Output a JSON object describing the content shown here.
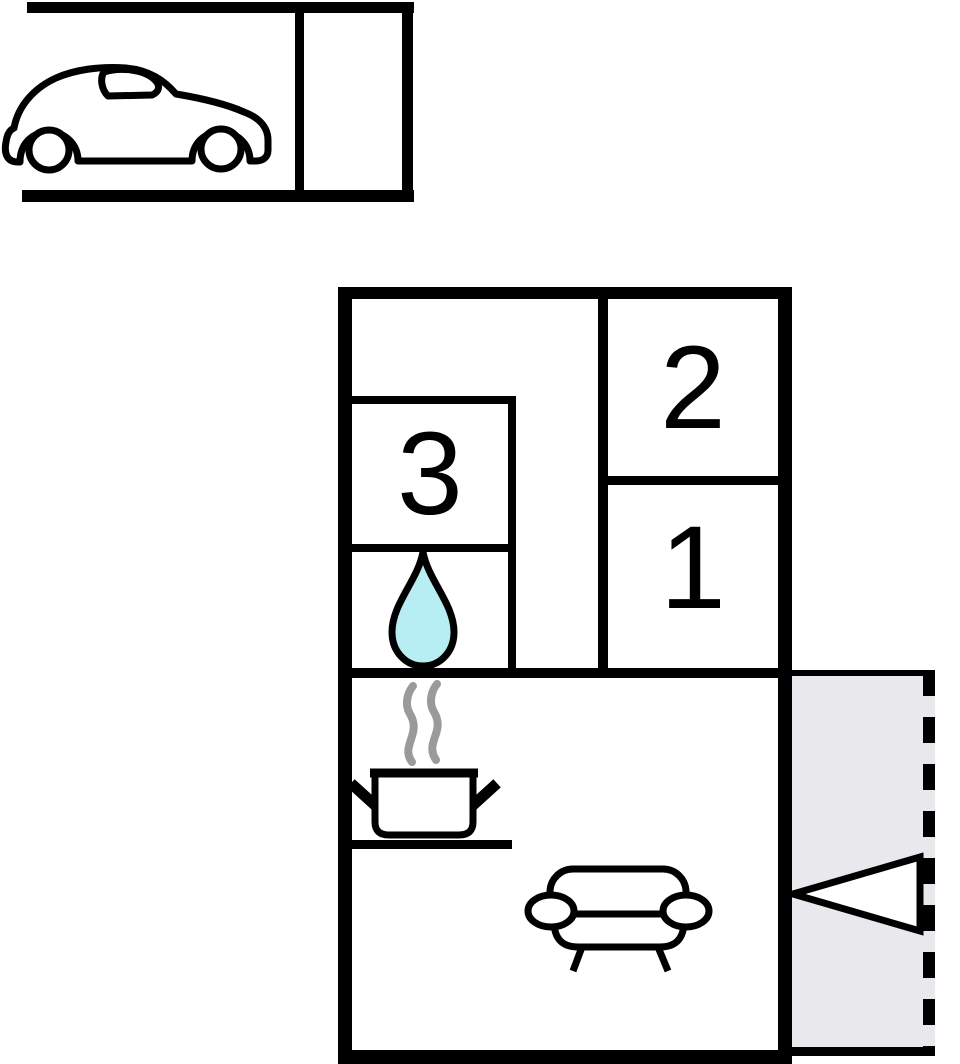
{
  "colors": {
    "wall": "#000000",
    "paper": "#ffffff",
    "terrace_fill": "#e9e9ed",
    "water_fill": "#b7eef4",
    "steam": "#9a9a9a"
  },
  "plan": {
    "room_labels": [
      {
        "id": "room-1",
        "label": "1"
      },
      {
        "id": "room-2",
        "label": "2"
      },
      {
        "id": "room-3",
        "label": "3"
      }
    ],
    "icons": [
      "car-icon",
      "water-drop-icon",
      "steam-icon",
      "cooking-pot-icon",
      "sofa-icon",
      "entrance-arrow-icon"
    ]
  }
}
